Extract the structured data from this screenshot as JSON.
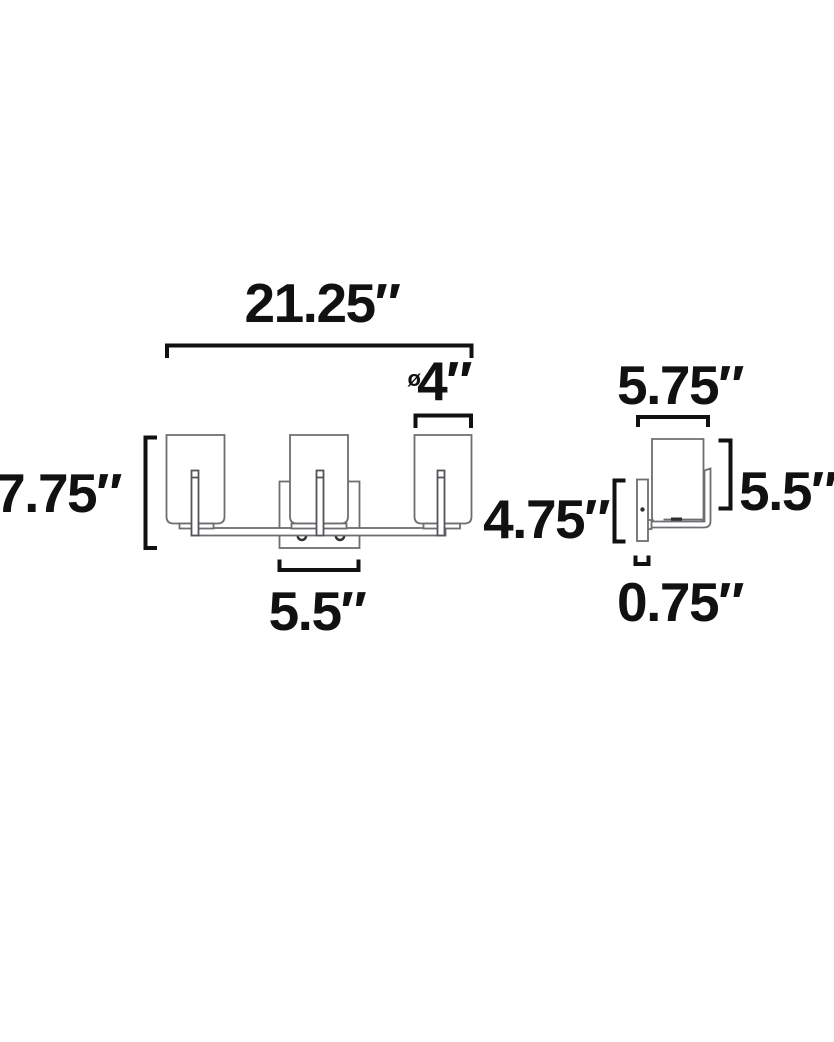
{
  "colors": {
    "background": "#ffffff",
    "dimension_line": "#111111",
    "dimension_text": "#111111",
    "fixture_outline": "#6d6e71",
    "fixture_dark_detail": "#2f2f31"
  },
  "front_view": {
    "overall_width_label": "21.25″",
    "shade_diameter_symbol": "ø",
    "shade_diameter_label": "4″",
    "overall_height_label": "7.75″",
    "canopy_width_label": "5.5″"
  },
  "side_view": {
    "overall_depth_label": "5.75″",
    "shade_height_label": "5.5″",
    "backplate_height_label": "4.75″",
    "backplate_depth_label": "0.75″"
  }
}
